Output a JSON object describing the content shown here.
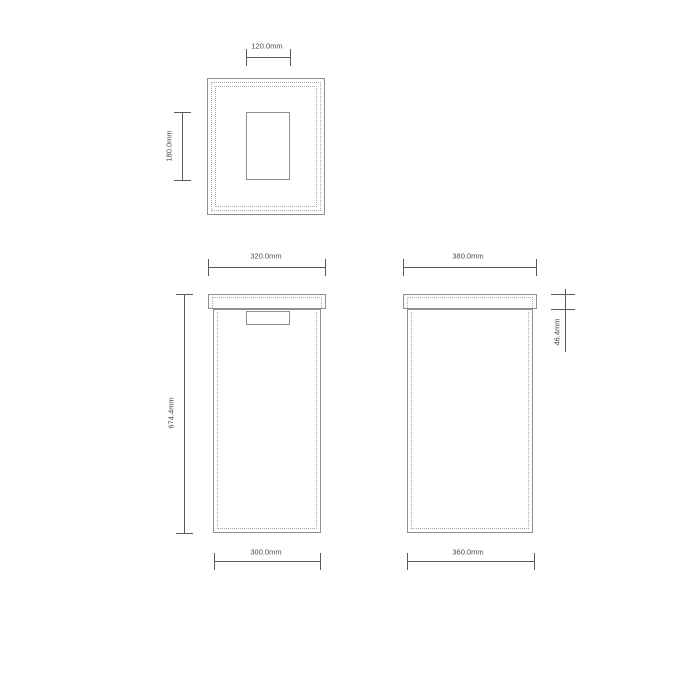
{
  "colors": {
    "background": "#ffffff",
    "part_outline": "#8f8f8f",
    "hidden_line": "#a9a9a9",
    "dimension_line": "#5a5a5a",
    "dimension_text": "#4a4a4a"
  },
  "views": {
    "top": {
      "dims": {
        "slot_width": "120.0mm",
        "slot_depth": "180.0mm"
      }
    },
    "front": {
      "dims": {
        "lid_width": "320.0mm",
        "overall_height": "674.4mm",
        "body_width": "300.0mm"
      }
    },
    "side": {
      "dims": {
        "lid_depth": "380.0mm",
        "lid_height": "46.4mm",
        "body_depth": "360.0mm"
      }
    }
  }
}
